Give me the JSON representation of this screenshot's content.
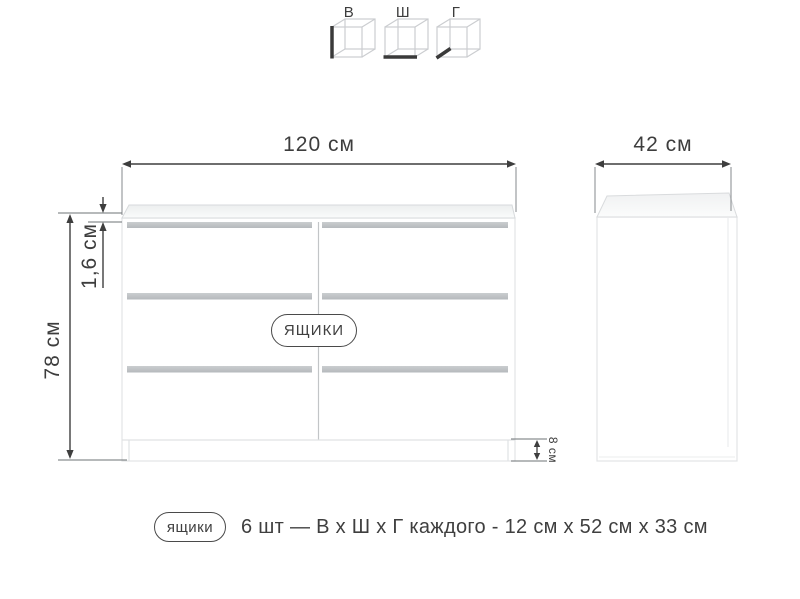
{
  "legend": {
    "items": [
      {
        "label": "В",
        "meaning": "height-cube-icon"
      },
      {
        "label": "Ш",
        "meaning": "width-cube-icon"
      },
      {
        "label": "Г",
        "meaning": "depth-cube-icon"
      }
    ]
  },
  "dims": {
    "front_width": {
      "label": "120 см"
    },
    "front_height": {
      "label": "78 см"
    },
    "top_thickness": {
      "label": "1,6 см"
    },
    "plinth_height": {
      "label": "8 см"
    },
    "side_depth": {
      "label": "42 см"
    }
  },
  "front_view": {
    "drawers_tag": "ЯЩИКИ",
    "drawer_rows": 3,
    "drawer_columns": 2
  },
  "caption": {
    "tag": "ящики",
    "text": "6 шт — В х Ш х Г каждого - 12 см х 52 см х 33 см"
  },
  "colors": {
    "text": "#3d3d3d",
    "dimension_line": "#3e3e3e",
    "extension_line": "#85898c",
    "cabinet_edge": "#e2e4e6",
    "drawer_gap_strip": "#bfc3c5",
    "cube_wireframe": "#cbcdd0"
  }
}
